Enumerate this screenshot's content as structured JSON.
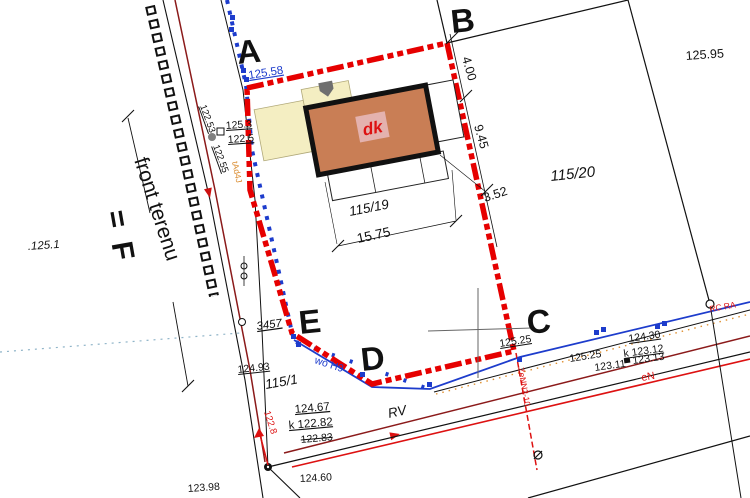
{
  "labels": {
    "a": "A",
    "b": "B",
    "c": "C",
    "d": "D",
    "e": "E",
    "parcel_115_19": "115/19",
    "parcel_115_20": "115/20",
    "parcel_115_1": "115/1",
    "dim_4_00": "4.00",
    "dim_9_45": "9.45",
    "dim_3_52": "3.52",
    "dim_15_75": "15.75",
    "elev_125_95": "125.95",
    "elev_125_58": "125.58",
    "elev_125_3": "125.3",
    "elev_122_5": "122.5",
    "elev_122_53": "122.53",
    "elev_122_55": "122.55",
    "elev_125_1": ".125.1",
    "front_terenu": "front terenu",
    "f_mark": "= F",
    "num_3457": "3457",
    "elev_124_93": "124.93",
    "elev_124_67": "124.67",
    "k_122_82": "k 122.82",
    "elev_122_83": "122.83",
    "elev_122_8": "122.8",
    "elev_123_98": "123.98",
    "elev_124_60": "124.60",
    "rv": "RV",
    "elev_125_25_a": "125.25",
    "elev_125_25_b": "125.25",
    "elev_124_30": "124.30",
    "k_123_12": "k 123.12",
    "elev_123_11": "123.11",
    "elev_123_13": "123.13",
    "en_street": "eN",
    "rc_ra": "RC RA",
    "en_c_line": "ZeNN2-10",
    "wo_h9": "wo H9",
    "gas_line": "tAd4J",
    "dk": "dk"
  },
  "colors": {
    "boundary_red": "#e60000",
    "utility_blue": "#1d3ccc",
    "utility_darkred": "#8b1a1a",
    "utility_red": "#dd1111",
    "building_fill": "#c97e55",
    "annex_fill": "#f4eec2"
  }
}
